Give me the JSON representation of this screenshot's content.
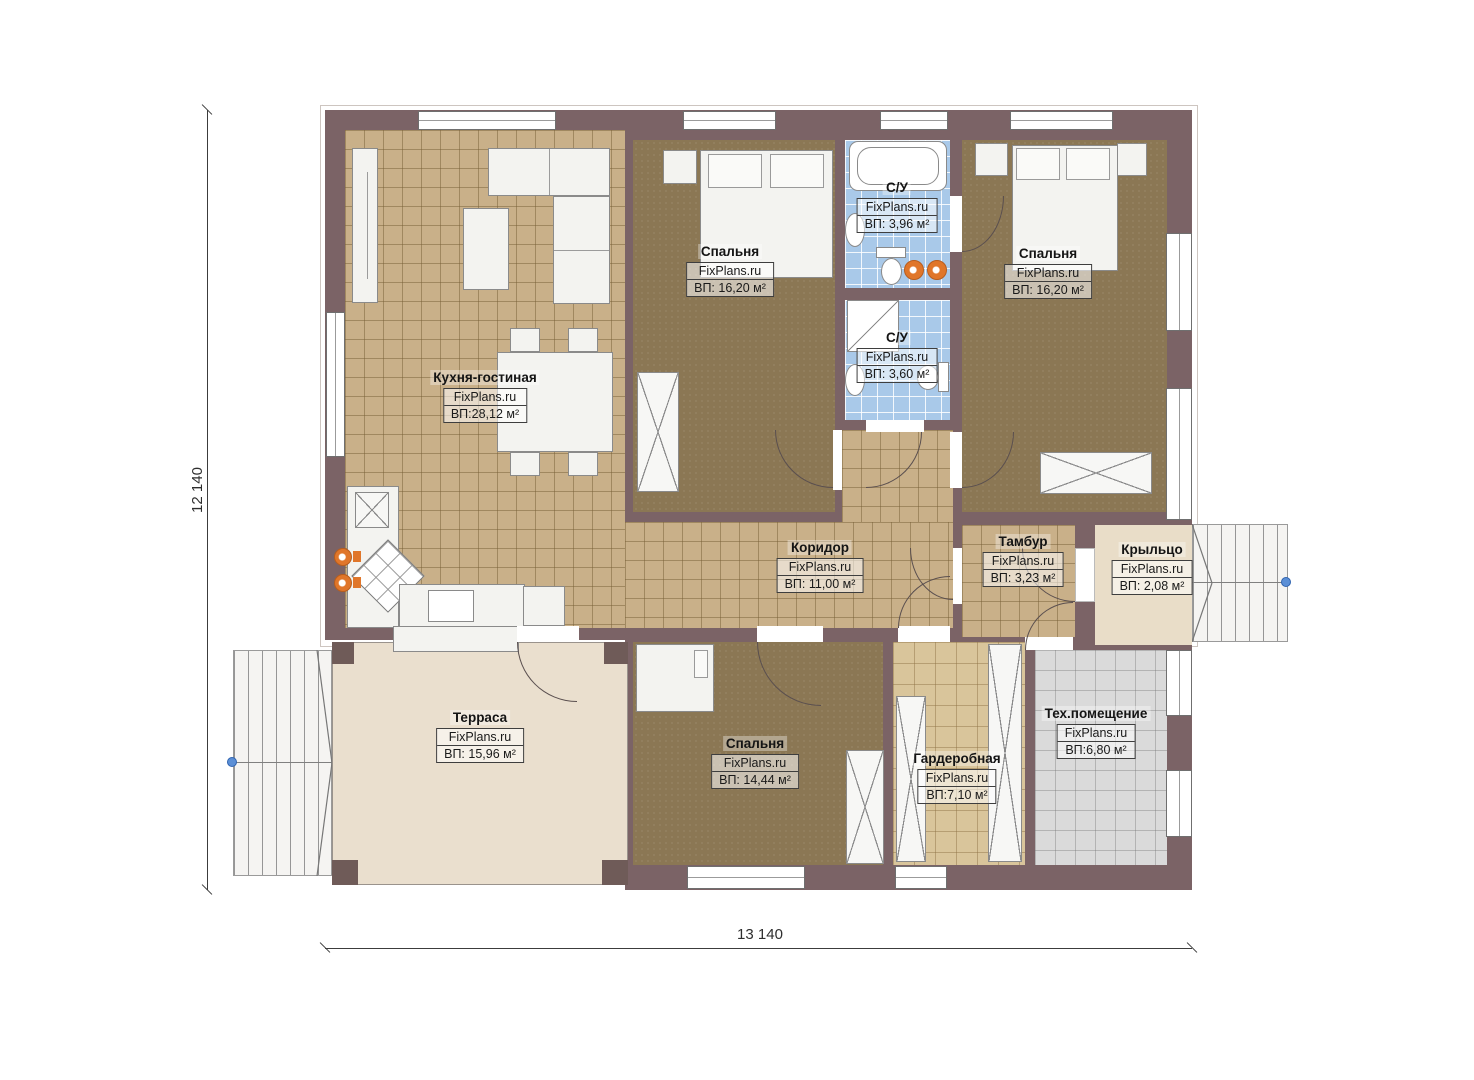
{
  "dimensions": {
    "left": "12 140",
    "bottom": "13 140"
  },
  "watermark": "FixPlans.ru",
  "rooms": [
    {
      "id": "kitchen-living",
      "name": "Кухня-гостиная",
      "watermark": "FixPlans.ru",
      "area": "ВП:28,12 м²"
    },
    {
      "id": "bedroom-top-center",
      "name": "Спальня",
      "watermark": "FixPlans.ru",
      "area": "ВП: 16,20 м²"
    },
    {
      "id": "bathroom-1",
      "name": "С/У",
      "watermark": "FixPlans.ru",
      "area": "ВП: 3,96 м²"
    },
    {
      "id": "bathroom-2",
      "name": "С/У",
      "watermark": "FixPlans.ru",
      "area": "ВП: 3,60 м²"
    },
    {
      "id": "bedroom-top-right",
      "name": "Спальня",
      "watermark": "FixPlans.ru",
      "area": "ВП: 16,20 м²"
    },
    {
      "id": "corridor",
      "name": "Коридор",
      "watermark": "FixPlans.ru",
      "area": "ВП: 11,00 м²"
    },
    {
      "id": "vestibule",
      "name": "Тамбур",
      "watermark": "FixPlans.ru",
      "area": "ВП: 3,23 м²"
    },
    {
      "id": "porch",
      "name": "Крыльцо",
      "watermark": "FixPlans.ru",
      "area": "ВП: 2,08 м²"
    },
    {
      "id": "terrace",
      "name": "Терраса",
      "watermark": "FixPlans.ru",
      "area": "ВП: 15,96 м²"
    },
    {
      "id": "bedroom-bottom",
      "name": "Спальня",
      "watermark": "FixPlans.ru",
      "area": "ВП: 14,44 м²"
    },
    {
      "id": "wardrobe-room",
      "name": "Гардеробная",
      "watermark": "FixPlans.ru",
      "area": "ВП:7,10 м²"
    },
    {
      "id": "tech-room",
      "name": "Тех.помещение",
      "watermark": "FixPlans.ru",
      "area": "ВП:6,80 м²"
    }
  ],
  "colors": {
    "wall": "#7b6366",
    "floor_tan": "#c9b089",
    "floor_brown": "#8b7754",
    "tile_blue": "#a9c9e9",
    "tile_gray": "#dadada",
    "terrace_beige": "#eadfce",
    "accent_orange": "#e0762a",
    "marker_blue": "#5b8fd6"
  }
}
